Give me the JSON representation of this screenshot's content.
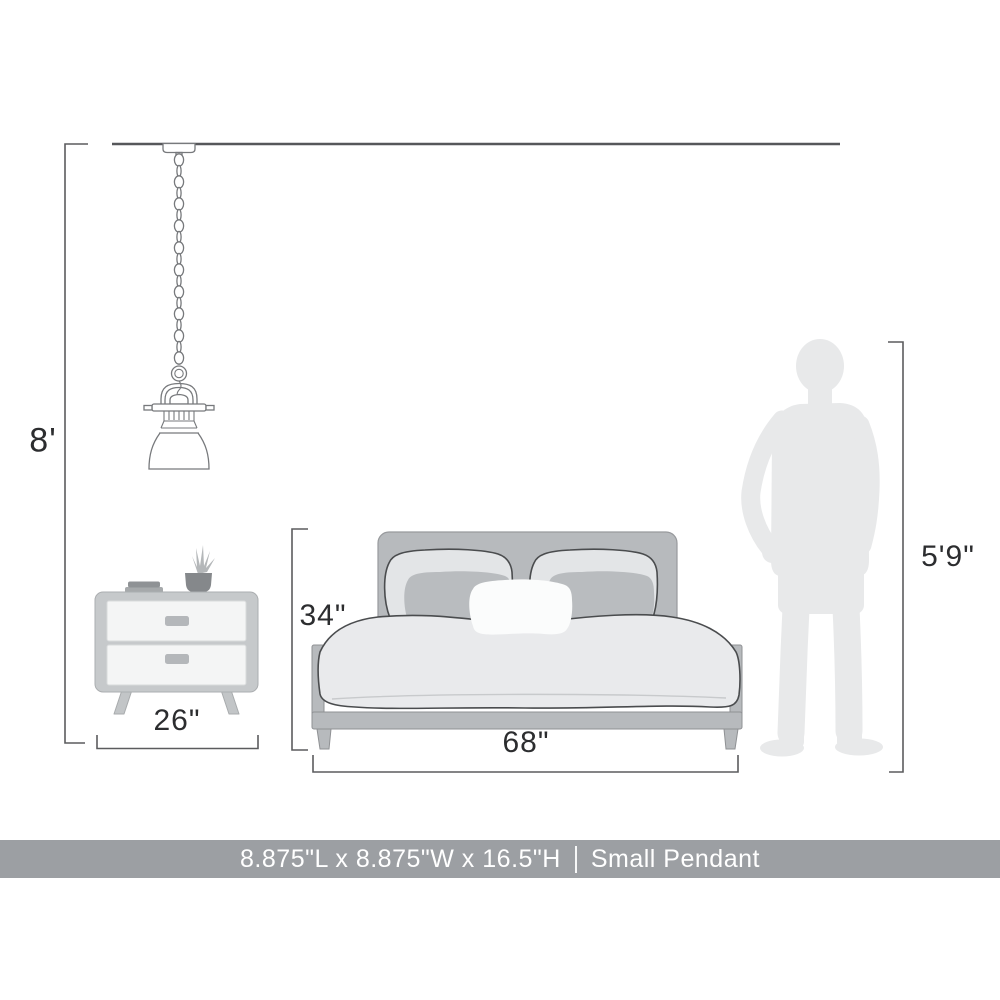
{
  "dimension_labels": {
    "ceiling_height": "8'",
    "bed_height": "34\"",
    "nightstand_width": "26\"",
    "bed_width": "68\"",
    "person_height": "5'9\""
  },
  "banner": {
    "dimensions": "8.875\"L x 8.875\"W x 16.5\"H",
    "separator": "|",
    "product": "Small Pendant"
  },
  "illustrations": [
    "pendant-light-illustration",
    "nightstand-illustration",
    "bed-illustration",
    "person-silhouette"
  ],
  "colors": {
    "banner_bg": "#9C9FA3",
    "banner_text": "#FFFFFF",
    "label_text": "#2C2D2F",
    "dim_line": "#5B5C5E",
    "ceiling_line": "#56575A",
    "outline_dark": "#4A4C4E",
    "outline_light": "#77797C",
    "furniture_gray": "#B7BABD",
    "furniture_gray_light": "#C6C9CB",
    "drawer_fill": "#F4F5F5",
    "duvet_fill": "#E9EAEC",
    "pillow_back_fill": "#E3E5E7",
    "pillow_accent_fill": "#B9BCBF",
    "pillow_center_fill": "#FBFCFC",
    "silhouette_fill": "#E8E9EA"
  }
}
